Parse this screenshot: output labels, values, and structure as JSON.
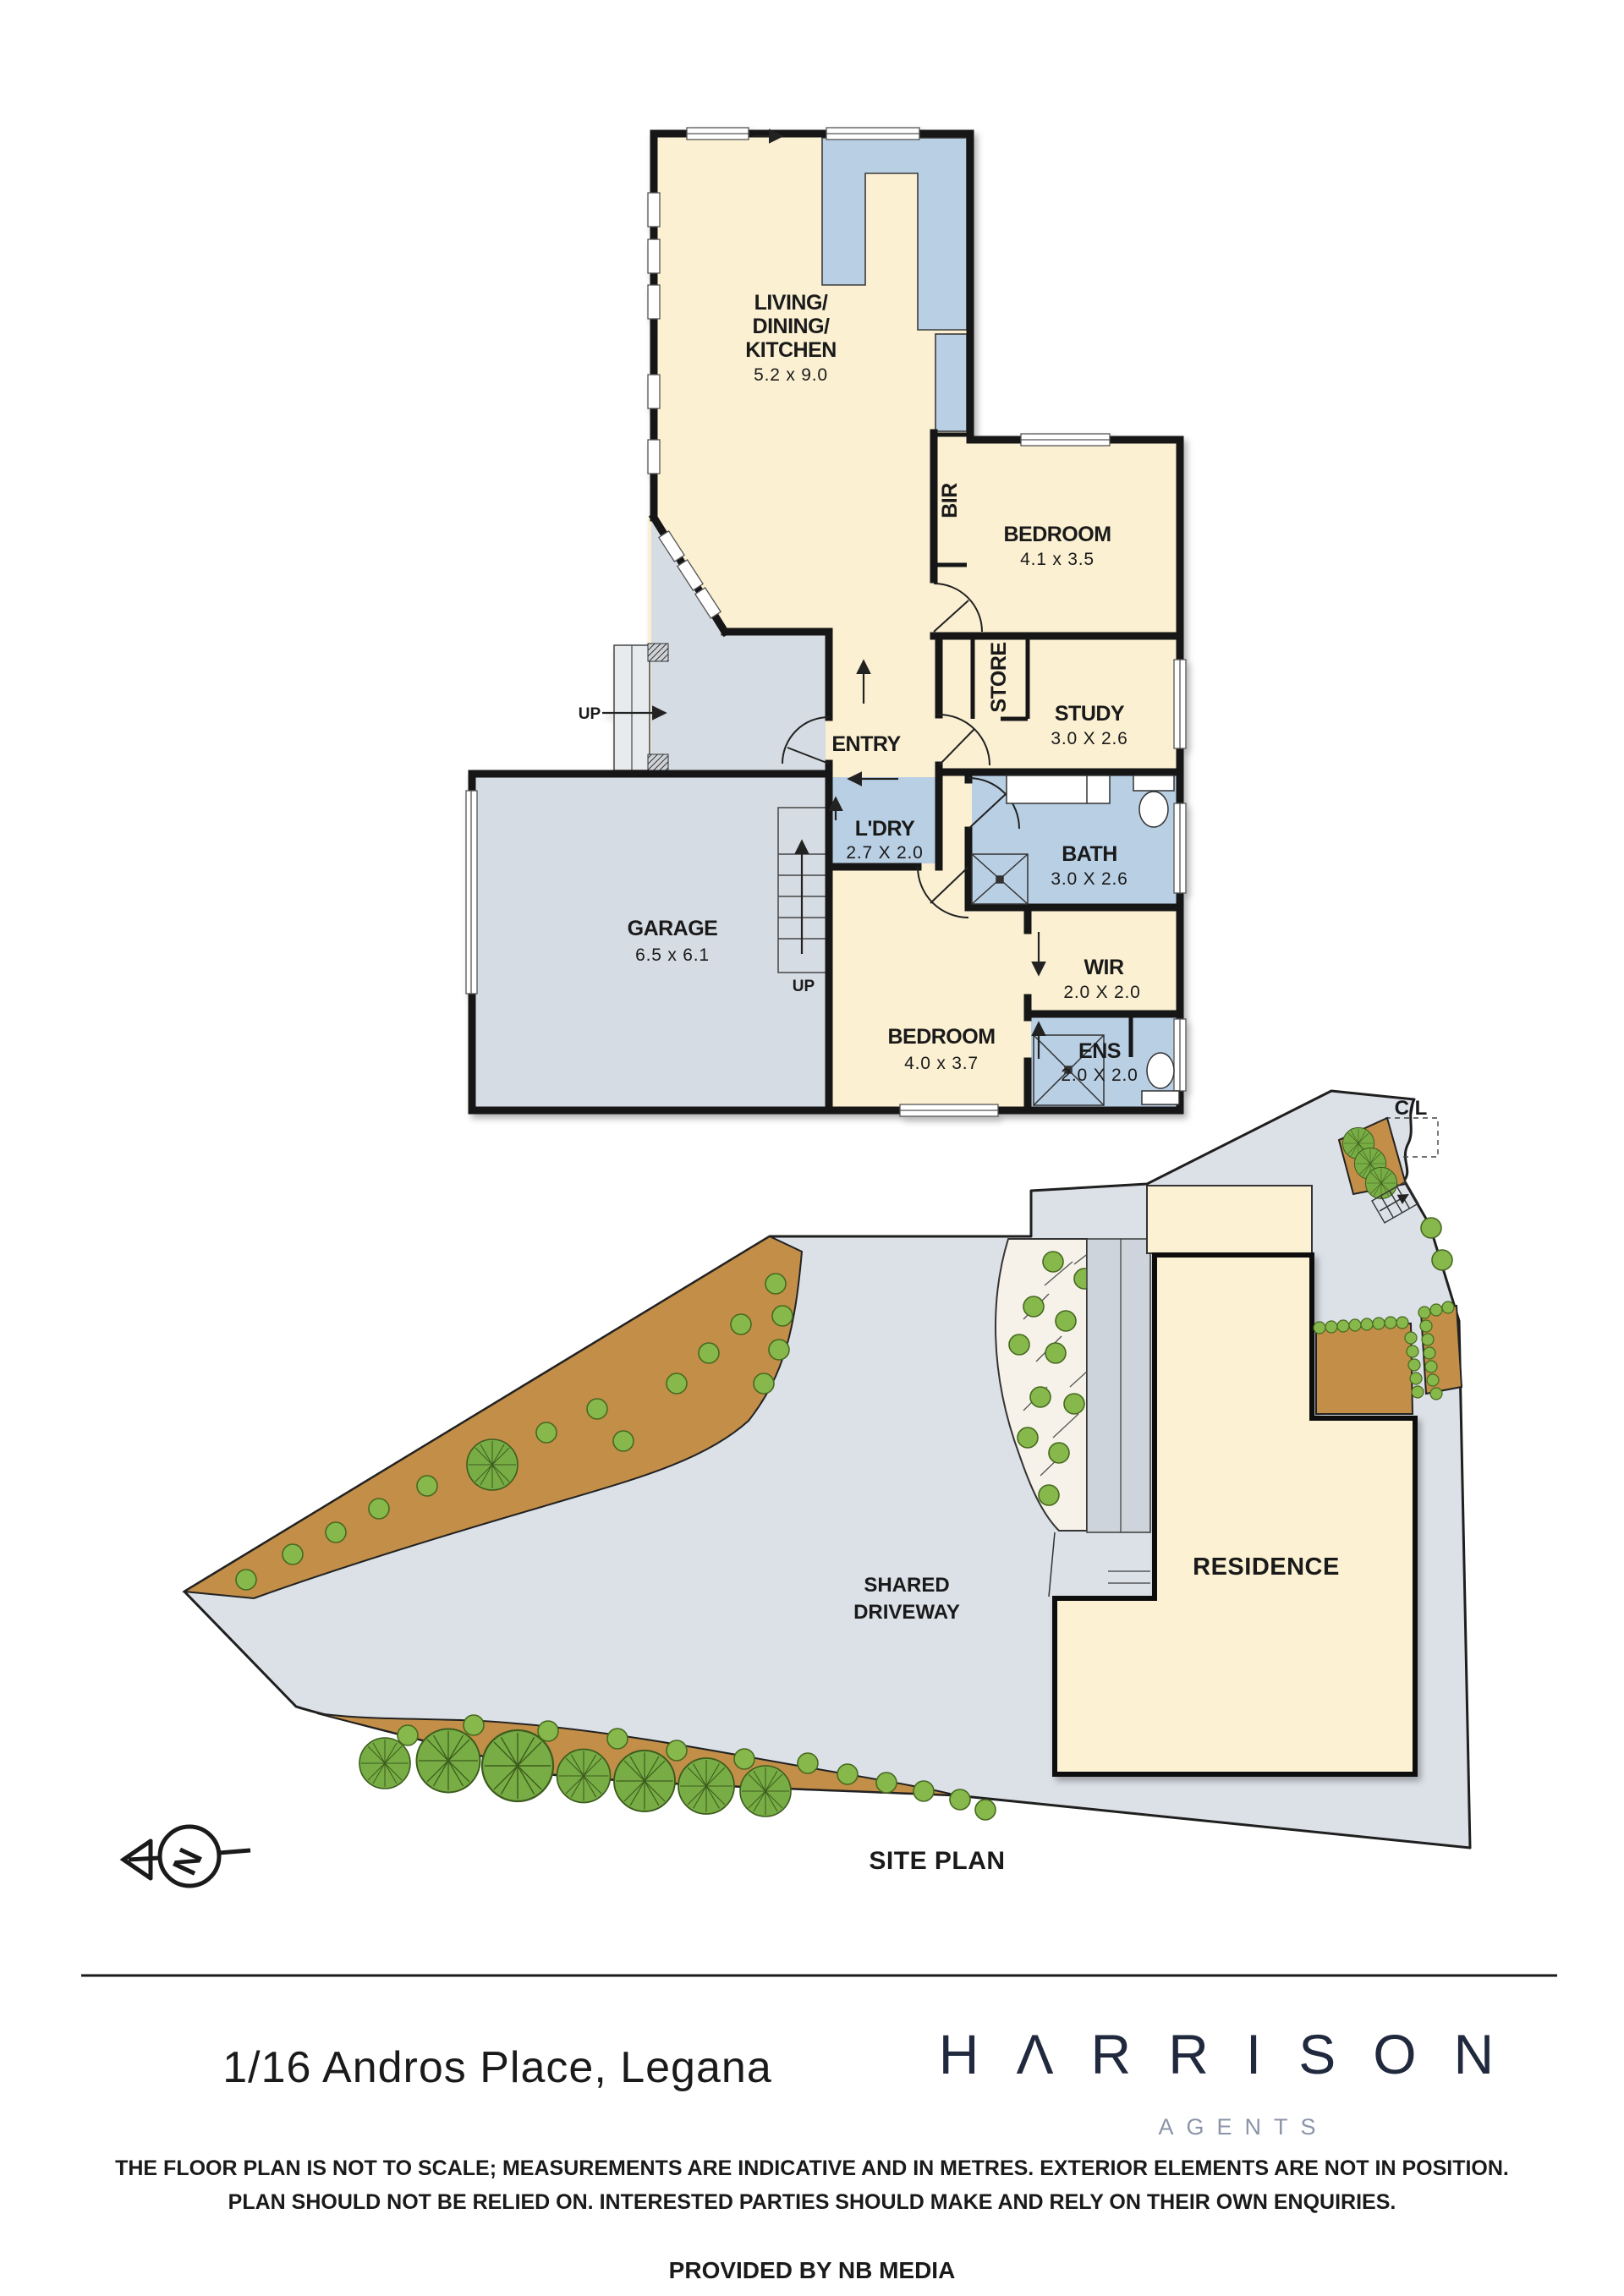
{
  "floor_plan": {
    "rooms": {
      "living": {
        "line1": "LIVING/",
        "line2": "DINING/",
        "line3": "KITCHEN",
        "dims": "5.2 x 9.0"
      },
      "bedroom1": {
        "name": "BEDROOM",
        "dims": "4.1 x 3.5"
      },
      "study": {
        "name": "STUDY",
        "dims": "3.0 X 2.6"
      },
      "bath": {
        "name": "BATH",
        "dims": "3.0 X 2.6"
      },
      "ldry": {
        "name": "L'DRY",
        "dims": "2.7 X 2.0"
      },
      "garage": {
        "name": "GARAGE",
        "dims": "6.5 x 6.1"
      },
      "bedroom2": {
        "name": "BEDROOM",
        "dims": "4.0 x 3.7"
      },
      "wir": {
        "name": "WIR",
        "dims": "2.0 X 2.0"
      },
      "ens": {
        "name": "ENS",
        "dims": "2.0 X 2.0"
      },
      "entry": {
        "name": "ENTRY"
      },
      "bir": {
        "name": "BIR"
      },
      "store": {
        "name": "STORE"
      }
    },
    "labels": {
      "up_porch": "UP",
      "up_stairs": "UP"
    }
  },
  "site_plan": {
    "shared_driveway_line1": "SHARED",
    "shared_driveway_line2": "DRIVEWAY",
    "residence": "RESIDENCE",
    "cl": "C/L",
    "title": "SITE PLAN",
    "compass_n": "N"
  },
  "footer": {
    "address": "1/16 Andros Place, Legana",
    "logo_wordmark_display": "HΛRRISON",
    "logo_wordmark": "HARRISON",
    "logo_subtitle": "AGENTS",
    "disclaimer_line1": "THE FLOOR PLAN IS NOT TO SCALE; MEASUREMENTS ARE INDICATIVE AND IN METRES. EXTERIOR ELEMENTS ARE NOT IN POSITION.",
    "disclaimer_line2": "PLAN SHOULD NOT BE RELIED ON. INTERESTED PARTIES SHOULD MAKE AND RELY ON THEIR OWN ENQUIRIES.",
    "provided_by": "PROVIDED BY NB MEDIA"
  },
  "colors": {
    "room_cream": "#FBF0D2",
    "wet_blue": "#B9CFE4",
    "garage_gray": "#D6DCE3",
    "driveway_gray": "#DCE1E8",
    "garden_brown": "#C28E48",
    "tree_green": "#86B84B",
    "logo_navy": "#20293D",
    "agents_gray": "#8B94A8",
    "wall_black": "#161616"
  }
}
